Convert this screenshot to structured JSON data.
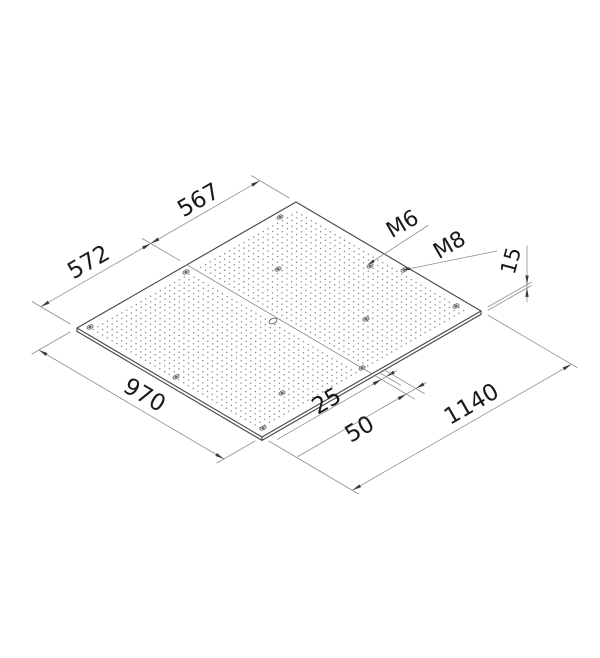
{
  "page": {
    "background": "#ffffff",
    "width": 600,
    "height": 658
  },
  "drawing": {
    "type": "isometric-technical-drawing",
    "subject": "perforated mounting plate",
    "style": {
      "thin_line_color": "#8f8f8f",
      "edge_color": "#4a4a4a",
      "seam_color": "#7d7d7d",
      "arrow_color": "#3a3a3a",
      "text_color": "#1a1a1a",
      "dot_color": "#8a8a8a",
      "hole_stroke": "#4f4f4f",
      "hole_fill": "#e6e6e6",
      "hole_core": "#5a5a5a",
      "plate_fill": "#ffffff",
      "thin_w": 0.8,
      "edge_w": 1.15,
      "seam_w": 0.8
    },
    "basis": {
      "origin": [
        77,
        328
      ],
      "eu": [
        0.1921,
        -0.1105
      ],
      "ev": [
        0.1907,
        0.1124
      ]
    },
    "plate": {
      "corners": {
        "W": [
          77,
          328
        ],
        "N": [
          296,
          202
        ],
        "E": [
          481,
          311
        ],
        "S": [
          262,
          437
        ]
      },
      "thickness_px": 3.4,
      "seam": [
        186.9,
        264.8,
        371.9,
        373.8
      ]
    },
    "grid": {
      "pitch_mm": 25,
      "dot_r": 0.75,
      "v0": 48,
      "v1": 923,
      "sections": [
        {
          "u0": 36,
          "u1": 536
        },
        {
          "u0": 597,
          "u1": 1097
        }
      ]
    },
    "holes": {
      "counterbore": [
        [
          90,
          327
        ],
        [
          186,
          272
        ],
        [
          278,
          269
        ],
        [
          370,
          266
        ],
        [
          404,
          270
        ],
        [
          280,
          217
        ],
        [
          456,
          306
        ],
        [
          263,
          428
        ],
        [
          176,
          377
        ],
        [
          362,
          368
        ],
        [
          282,
          393
        ],
        [
          366,
          319
        ]
      ],
      "open": [
        [
          273,
          321
        ]
      ]
    },
    "dimensions": [
      {
        "label": "572",
        "font": 23,
        "rot": -30,
        "lx": 89,
        "ly": 263,
        "ext": [
          [
            70.1,
            323.9,
            32.2,
            301.6
          ],
          [
            180.0,
            260.7,
            142.1,
            238.4
          ]
        ],
        "line": [
          [
            40.8,
            306.7,
            150.7,
            243.5
          ]
        ],
        "arrows": [
          {
            "t": [
              40.8,
              306.7
            ],
            "d": [
              -0.867,
              0.499
            ]
          },
          {
            "t": [
              150.7,
              243.5
            ],
            "d": [
              0.867,
              -0.499
            ]
          }
        ]
      },
      {
        "label": "567",
        "font": 23,
        "rot": -30,
        "lx": 199,
        "ly": 201,
        "ext": [
          [
            289.1,
            197.9,
            251.2,
            175.6
          ]
        ],
        "line": [
          [
            150.7,
            243.5,
            259.8,
            180.7
          ]
        ],
        "arrows": [
          {
            "t": [
              150.7,
              243.5
            ],
            "d": [
              -0.867,
              0.499
            ]
          },
          {
            "t": [
              259.8,
              180.7
            ],
            "d": [
              0.867,
              -0.499
            ]
          }
        ]
      },
      {
        "label": "970",
        "font": 23,
        "rot": 30,
        "lx": 144,
        "ly": 396,
        "ext": [
          [
            70.1,
            332.0,
            31.9,
            354.0
          ],
          [
            255.1,
            441.0,
            216.9,
            463.0
          ]
        ],
        "line": [
          [
            38.9,
            350.0,
            223.9,
            459.0
          ]
        ],
        "arrows": [
          {
            "t": [
              38.9,
              350.0
            ],
            "d": [
              -0.861,
              -0.508
            ]
          },
          {
            "t": [
              223.9,
              459.0
            ],
            "d": [
              0.861,
              0.508
            ]
          }
        ]
      },
      {
        "label": "1140",
        "font": 23,
        "rot": -30,
        "lx": 472,
        "ly": 405,
        "ext": [
          [
            268.9,
            441.1,
            358.4,
            493.9
          ],
          [
            487.9,
            315.1,
            577.4,
            367.8
          ]
        ],
        "line": [
          [
            352.4,
            490.3,
            571.4,
            364.3
          ]
        ],
        "arrows": [
          {
            "t": [
              352.4,
              490.3
            ],
            "d": [
              -0.867,
              0.499
            ]
          },
          {
            "t": [
              571.4,
              364.3
            ],
            "d": [
              0.867,
              -0.499
            ]
          }
        ]
      },
      {
        "label": "15",
        "font": 21,
        "rot": -75,
        "lx": 512,
        "ly": 261,
        "ext": [
          [
            487.9,
            307.0,
            531.3,
            282.1
          ],
          [
            487.9,
            310.4,
            531.3,
            285.5
          ]
        ],
        "line": [
          [
            527,
            246,
            527,
            302
          ]
        ],
        "arrows": [
          {
            "t": [
              527,
              284.5
            ],
            "d": [
              0,
              1
            ]
          },
          {
            "t": [
              527,
              287.9
            ],
            "d": [
              0,
              -1
            ]
          }
        ]
      },
      {
        "label": "25",
        "font": 23,
        "rot": -30,
        "lx": 327,
        "ly": 402,
        "ext": [
          [
            375.3,
            375.8,
            414.9,
            399.2
          ],
          [
            380.1,
            373.0,
            400.8,
            385.2
          ]
        ],
        "line": [
          [
            277.4,
            439.3,
            396.6,
            370.6
          ]
        ],
        "arrows": [
          {
            "t": [
              381.4,
              379.4
            ],
            "d": [
              0.867,
              -0.499
            ]
          },
          {
            "t": [
              386.2,
              376.6
            ],
            "d": [
              -0.867,
              0.499
            ]
          }
        ]
      },
      {
        "label": "50",
        "font": 23,
        "rot": -30,
        "lx": 360,
        "ly": 430,
        "ext": [
          [
            384.9,
            370.2,
            424.5,
            393.6
          ]
        ],
        "line": [
          [
            297.9,
            456.5,
            426.3,
            382.5
          ]
        ],
        "arrows": [
          {
            "t": [
              406.3,
              394.1
            ],
            "d": [
              0.867,
              -0.499
            ]
          },
          {
            "t": [
              415.9,
              388.5
            ],
            "d": [
              -0.867,
              0.499
            ]
          }
        ]
      }
    ],
    "leaders": [
      {
        "label": "M6",
        "font": 22,
        "rot": -30,
        "lx": 403,
        "ly": 225,
        "line": [
          [
            368,
            264.5,
            428,
            225.5
          ]
        ],
        "arrow": {
          "t": [
            368,
            264.5
          ],
          "d": [
            -0.838,
            0.546
          ]
        }
      },
      {
        "label": "M8",
        "font": 22,
        "rot": -30,
        "lx": 450,
        "ly": 246,
        "line": [
          [
            403,
            270,
            497,
            251
          ]
        ],
        "arrow": {
          "t": [
            403,
            270
          ],
          "d": [
            -0.98,
            0.199
          ]
        }
      }
    ]
  }
}
